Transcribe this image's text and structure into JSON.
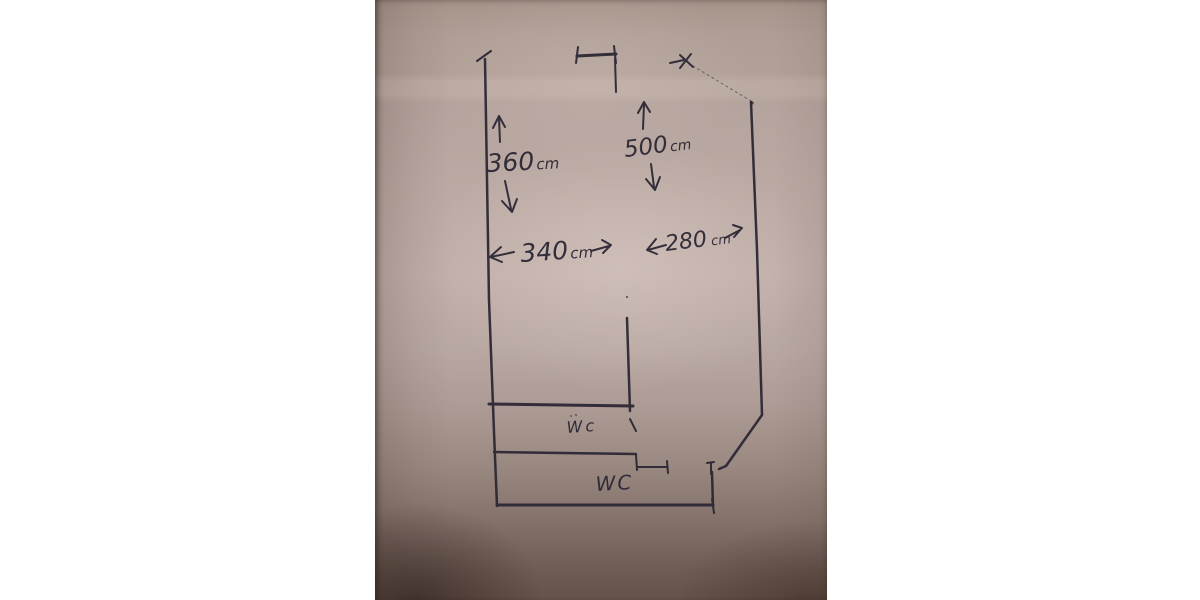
{
  "scene": {
    "description": "Hand-drawn floor plan sketch in pen on photographed paper",
    "background_color": "#ffffff",
    "paper_color": "#bcaba4",
    "ink_color": "#2b2734"
  },
  "dimensions": {
    "d360": {
      "value": "360",
      "unit": "cm",
      "orientation": "vertical-left"
    },
    "d500": {
      "value": "500",
      "unit": "cm",
      "orientation": "vertical-middle"
    },
    "d340": {
      "value": "340",
      "unit": "cm",
      "orientation": "horizontal-left"
    },
    "d280": {
      "value": "280",
      "unit": "cm",
      "orientation": "horizontal-right"
    }
  },
  "rooms": {
    "wc_upper": {
      "label": "Wc"
    },
    "wc_lower": {
      "label": "WC"
    }
  }
}
